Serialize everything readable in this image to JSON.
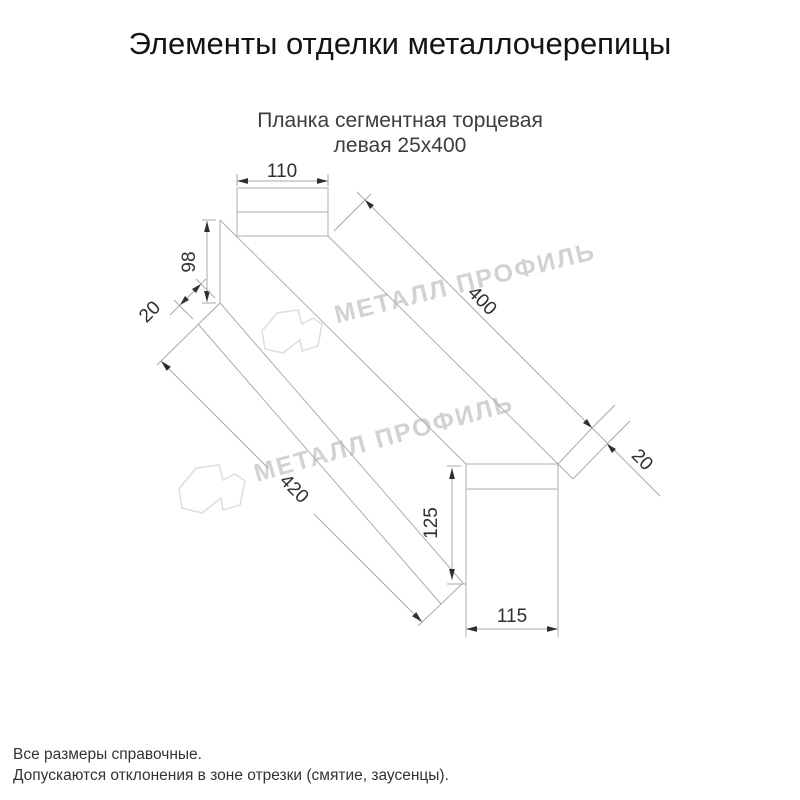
{
  "page": {
    "title": "Элементы отделки металлочерепицы",
    "subtitle_line1": "Планка сегментная торцевая",
    "subtitle_line2": "левая 25х400",
    "footer_line1": "Все размеры справочные.",
    "footer_line2": "Допускаются отклонения в зоне отрезки (смятие, заусенцы)."
  },
  "drawing": {
    "product": "Планка сегментная торцевая левая 25х400",
    "dimensions": {
      "top_flange_width": "110",
      "near_web_height": "98",
      "near_hem": "20",
      "top_length": "400",
      "far_hem": "20",
      "bottom_length": "420",
      "far_web_height": "125",
      "far_width": "115"
    }
  },
  "watermark": {
    "text": "МЕТАЛЛ ПРОФИЛЬ"
  },
  "colors": {
    "line": "#adadad",
    "dim_text": "#2e2e2e",
    "watermark": "#d2d2d2",
    "title": "#141414",
    "subtitle": "#3d3d3d",
    "footer": "#333333"
  }
}
